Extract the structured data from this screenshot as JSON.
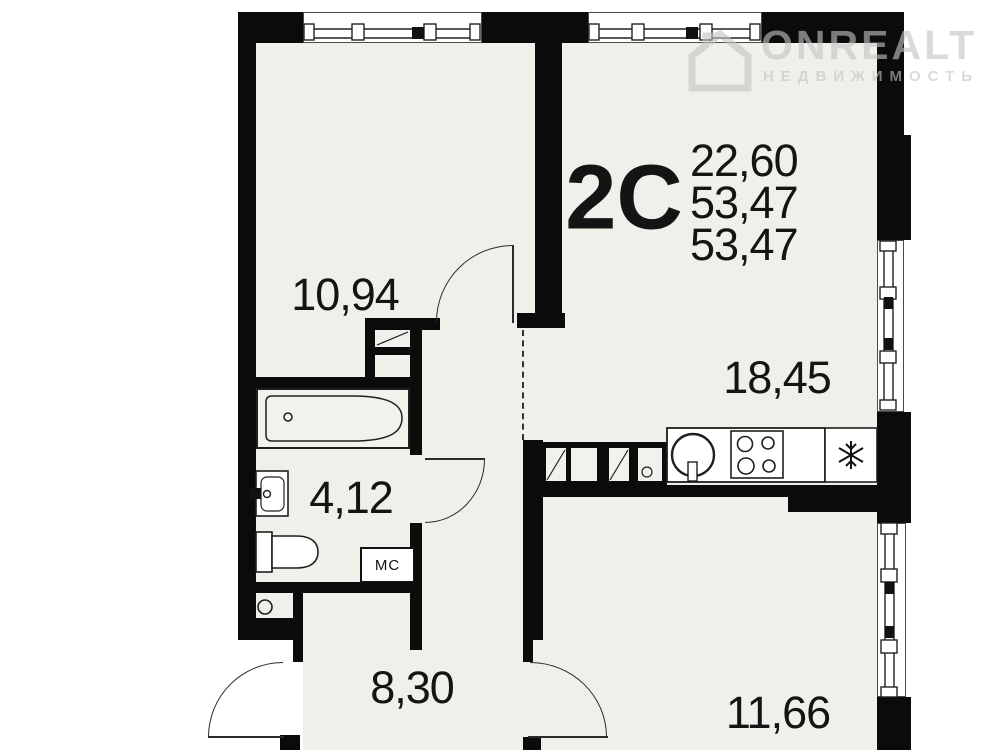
{
  "plan": {
    "type_label": "2С",
    "area_values": [
      "22,60",
      "53,47",
      "53,47"
    ],
    "rooms": [
      {
        "id": "bedroom",
        "label": "10,94"
      },
      {
        "id": "kitchen-living",
        "label": "18,45"
      },
      {
        "id": "bathroom",
        "label": "4,12"
      },
      {
        "id": "hallway",
        "label": "8,30"
      },
      {
        "id": "room-2",
        "label": "11,66"
      }
    ],
    "storage_label": "МС",
    "watermark": {
      "brand": "ONREALT",
      "subtitle": "НЕДВИЖИМОСТЬ"
    },
    "colors": {
      "wall": "#0b0b0b",
      "floor": "#f1efea",
      "line": "#222222",
      "text": "#141414",
      "watermark": "#c3c3c3"
    }
  }
}
